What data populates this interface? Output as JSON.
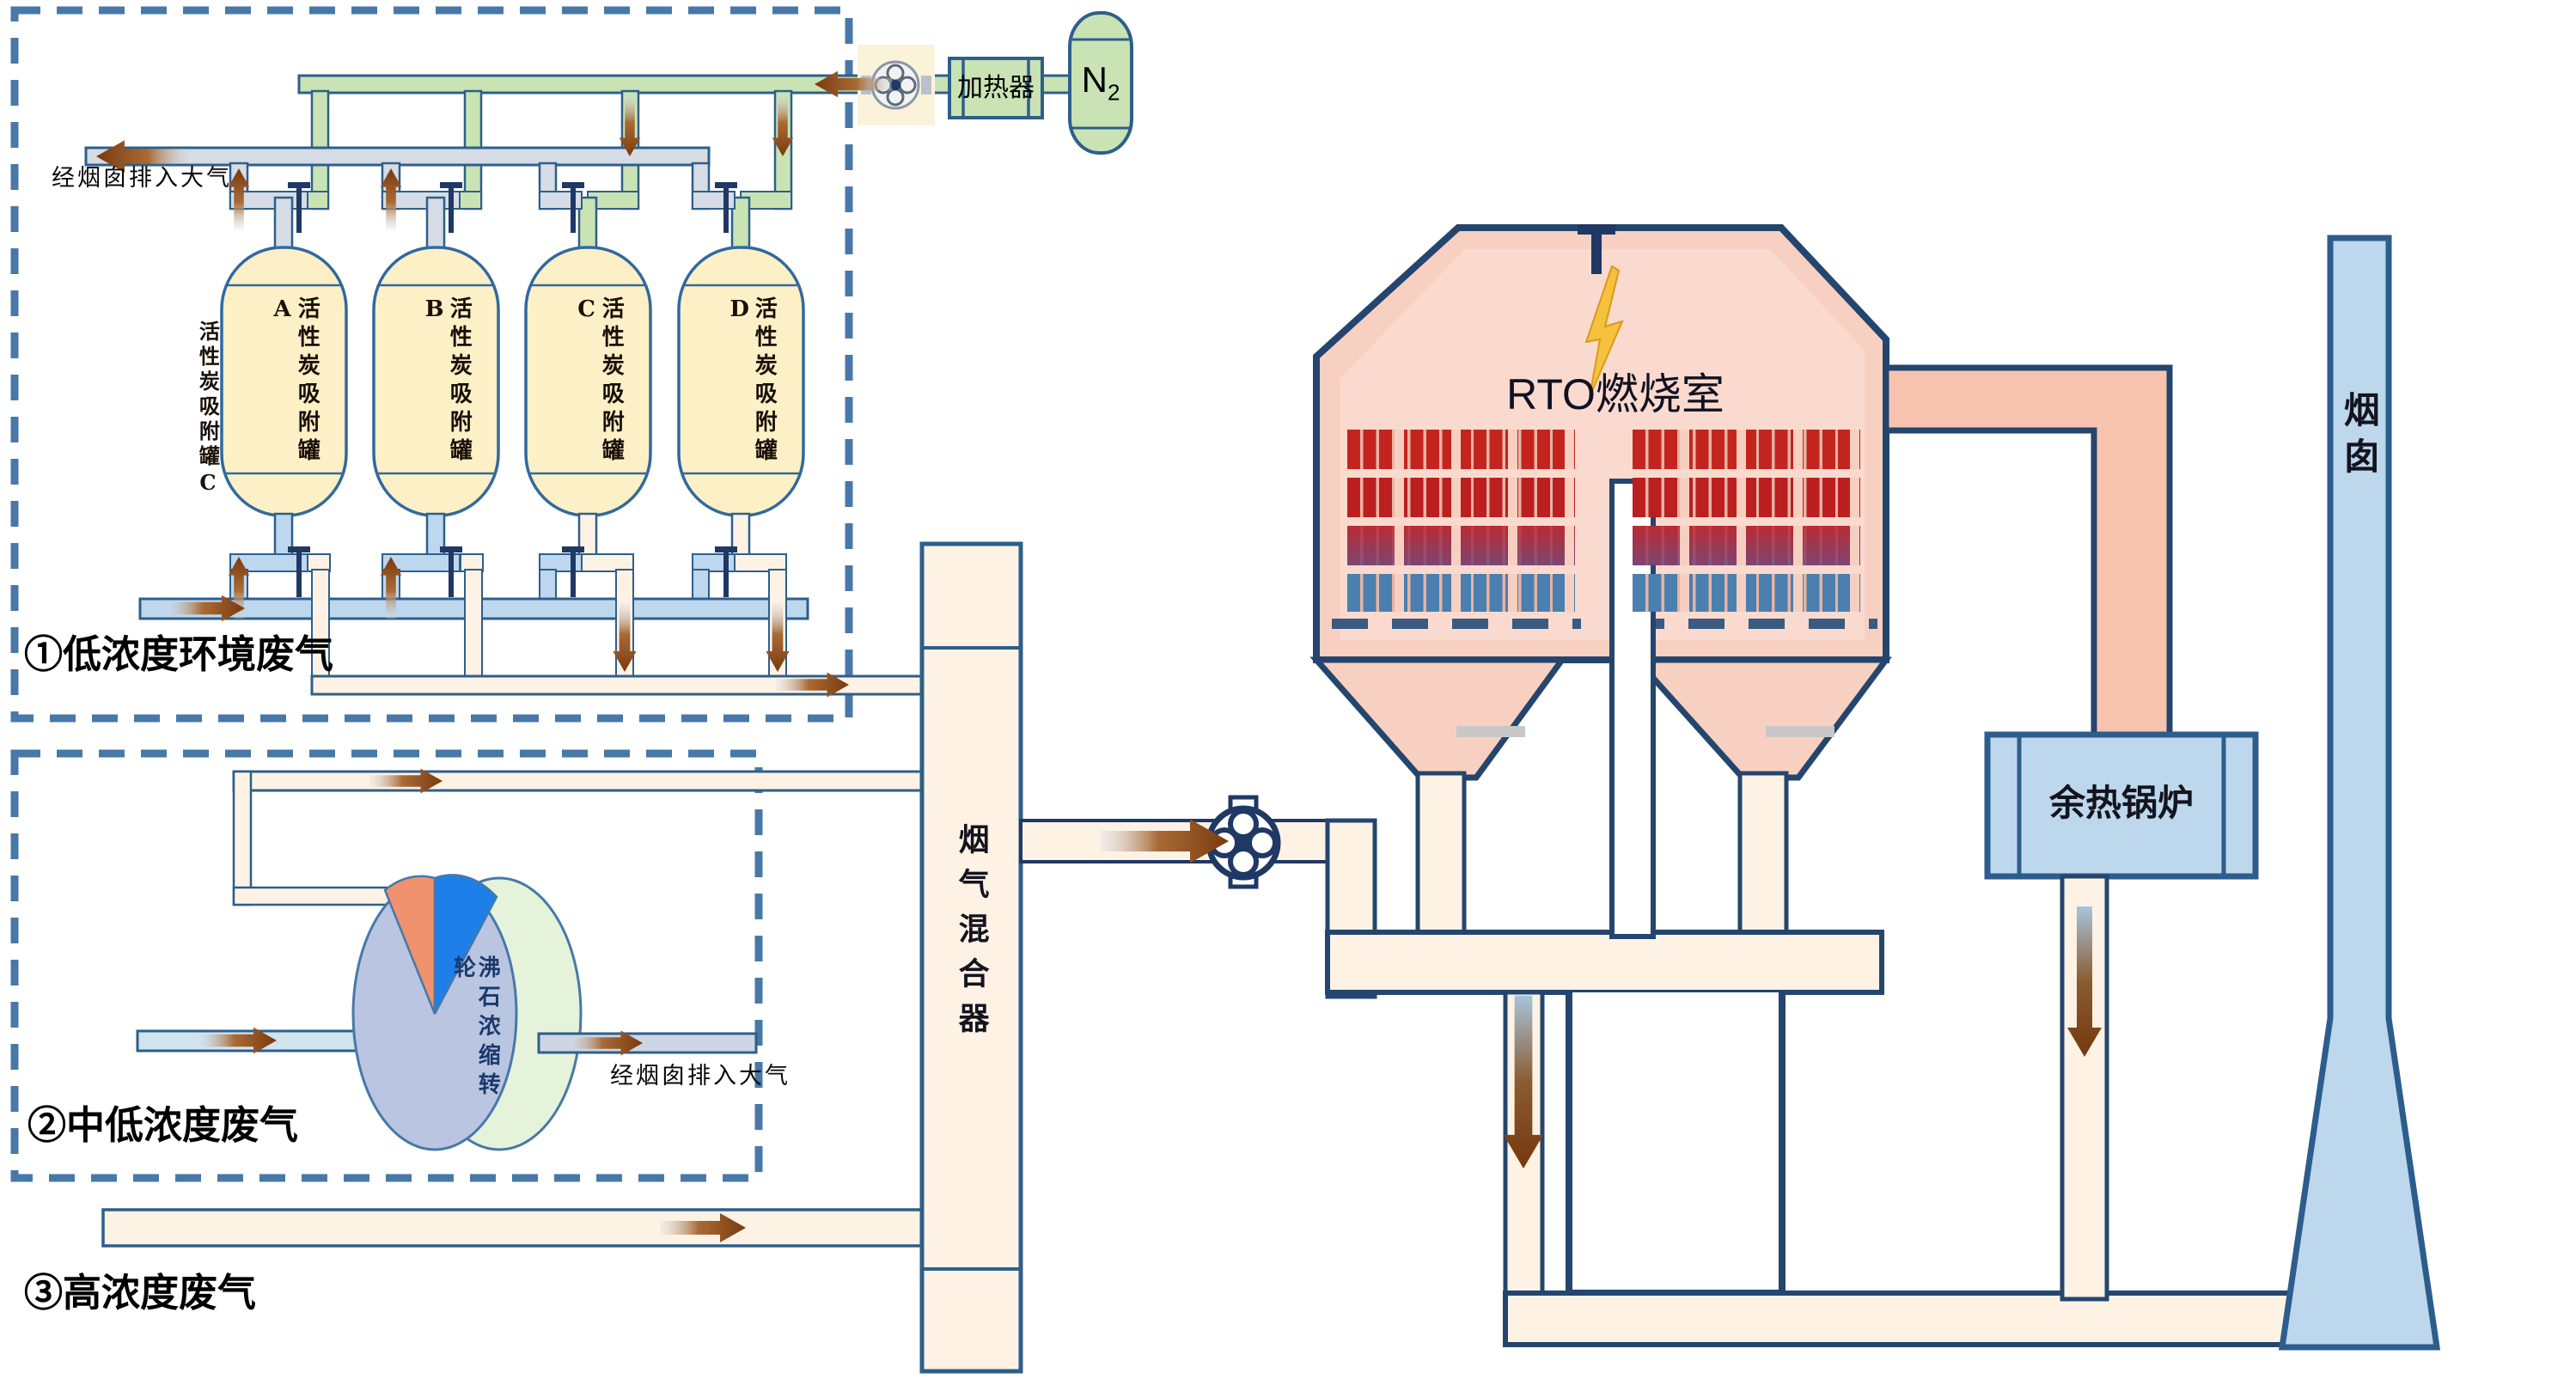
{
  "colors": {
    "pipe_green": "#C9E3B5",
    "pipe_gray": "#D6DCE5",
    "pipe_blue": "#BDD7EE",
    "pipe_cream": "#FDF2E4",
    "pipe_salmon": "#F8C3AE",
    "vessel_cream": "#FDF0C6",
    "rto_pink": "#F8D0C2",
    "media_red": "#C3251E",
    "media_blue": "#4A7FB0",
    "equipment_blue": "#BDD7EC",
    "outline_steel": "#2E5F8A",
    "outline_navy": "#1F3864",
    "arrow_brown": "#8A4513",
    "dash_border": "#4878A8",
    "wheel_front": "#B9C5E1",
    "wheel_back": "#E4F3DA",
    "wheel_orange": "#F0926E",
    "wheel_blue": "#1E7FE8",
    "flame_yellow": "#F6C23E"
  },
  "section_low": {
    "label": "①低浓度环境废气",
    "exhaust_label": "经烟囱排入大气",
    "external_tank_label": "活性炭吸附罐C",
    "tanks": [
      {
        "label": "活性炭吸附罐A"
      },
      {
        "label": "活性炭吸附罐B"
      },
      {
        "label": "活性炭吸附罐C"
      },
      {
        "label": "活性炭吸附罐D"
      }
    ]
  },
  "nitrogen": {
    "heater_label": "加热器",
    "tank_label": "N",
    "tank_label_sub": "2"
  },
  "section_mid": {
    "label": "②中低浓度废气",
    "wheel_label": "沸石浓缩转轮",
    "exhaust_label": "经烟囱排入大气"
  },
  "section_high": {
    "label": "③高浓度废气"
  },
  "mixer": {
    "label": "烟气混合器"
  },
  "rto": {
    "label": "RTO燃烧室"
  },
  "boiler": {
    "label": "余热锅炉"
  },
  "chimney": {
    "label": "烟囱"
  }
}
